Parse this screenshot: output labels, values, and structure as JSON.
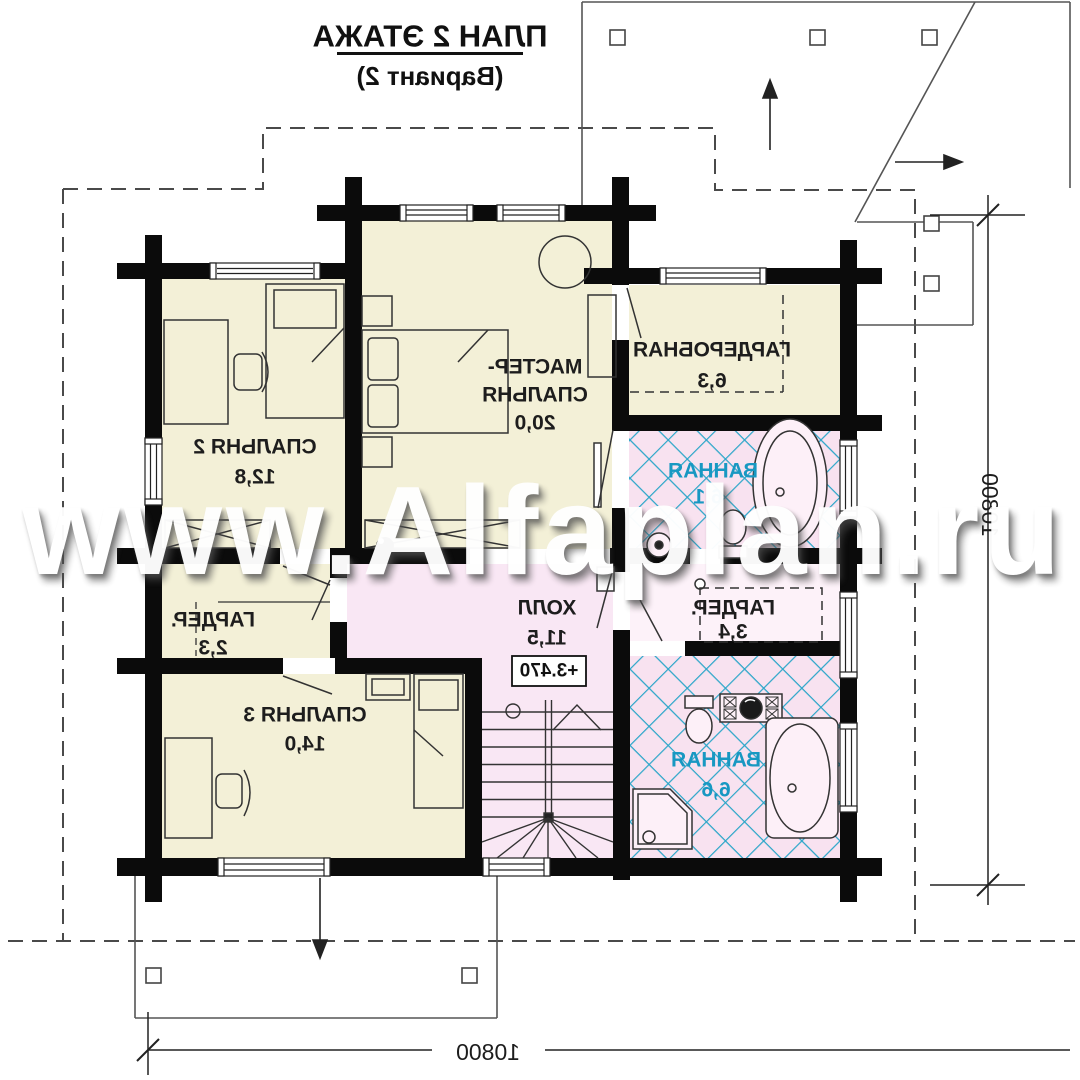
{
  "title": {
    "line1": "ПЛАН 2 ЭТАЖА",
    "line2": "(Вариант 2)"
  },
  "watermark": {
    "text": "www.Alfaplan.ru"
  },
  "rooms": [
    {
      "id": "bedroom-2",
      "name": "СПАЛЬНЯ 2",
      "area": "12,8"
    },
    {
      "id": "master-bedroom",
      "name_line1": "МАСТЕР-",
      "name_line2": "СПАЛЬНЯ",
      "area": "20,0"
    },
    {
      "id": "wardrobe",
      "name": "ГАРДЕРОБНАЯ",
      "area": "6,3"
    },
    {
      "id": "bathroom-1",
      "name": "ВАННАЯ",
      "area": "6,1"
    },
    {
      "id": "closet-1",
      "name": "ГАРДЕР.",
      "area": "2,3"
    },
    {
      "id": "hall",
      "name": "ХОЛЛ",
      "area": "11,5"
    },
    {
      "id": "closet-2",
      "name": "ГАРДЕР.",
      "area": "3,4"
    },
    {
      "id": "bedroom-3",
      "name": "СПАЛЬНЯ 3",
      "area": "14,0"
    },
    {
      "id": "bathroom-2",
      "name": "ВАННАЯ",
      "area": "6,6"
    }
  ],
  "elevation_mark": "+3.470",
  "dimensions": {
    "right": "10800",
    "bottom": "10800"
  },
  "colors": {
    "wall": "#0b0b0b",
    "room_cream": "#f3f0d7",
    "hall_pink": "#f9e7f4",
    "bath_tile_pink": "#f8e2f0",
    "tile_blue": "#2ba6c9",
    "bath_label_teal": "#1898c2",
    "watermark": "#ffffff"
  }
}
